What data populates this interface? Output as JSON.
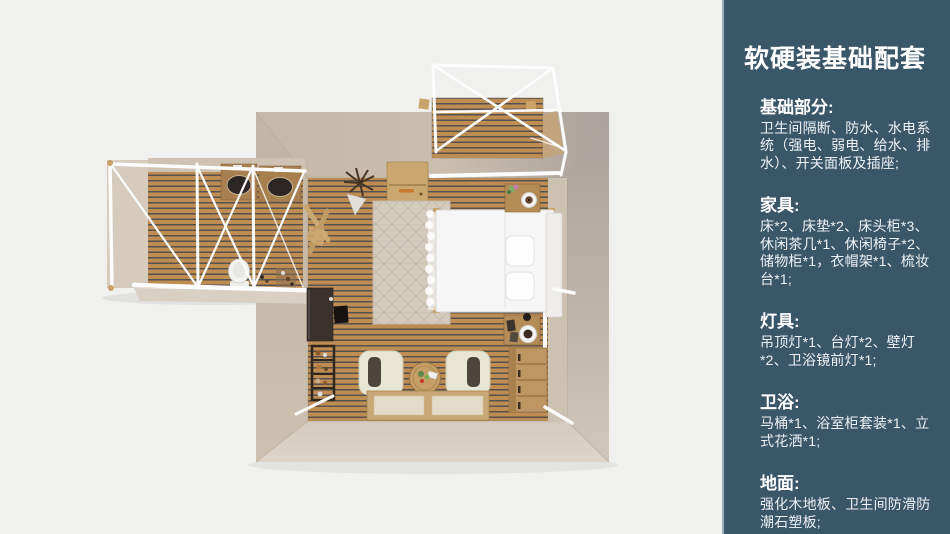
{
  "sidebar": {
    "title": "软硬装基础配套",
    "sections": [
      {
        "heading": "基础部分:",
        "body": "卫生间隔断、防水、水电系统（强电、弱电、给水、排水）、开关面板及插座;"
      },
      {
        "heading": "家具:",
        "body": "床*2、床垫*2、床头柜*3、休闲茶几*1、休闲椅子*2、储物柜*1，衣帽架*1、梳妆台*1;"
      },
      {
        "heading": "灯具:",
        "body": "吊顶灯*1、台灯*2、壁灯*2、卫浴镜前灯*1;"
      },
      {
        "heading": "卫浴:",
        "body": "马桶*1、浴室柜套装*1、立式花洒*1;"
      },
      {
        "heading": "地面:",
        "body": "强化木地板、卫生间防滑防潮石塑板;"
      }
    ]
  },
  "colors": {
    "background": "#f0f0ef",
    "sidebar": "#3a5669",
    "floor_wood": "#bf8c52",
    "floor_gap": "#565250",
    "wall_light": "#cbbeae",
    "wall_dark": "#a9a19b",
    "wall_bottom": "#d8cec2",
    "furniture_wood": "#b48c58",
    "frame_white": "#fcfcfc"
  }
}
